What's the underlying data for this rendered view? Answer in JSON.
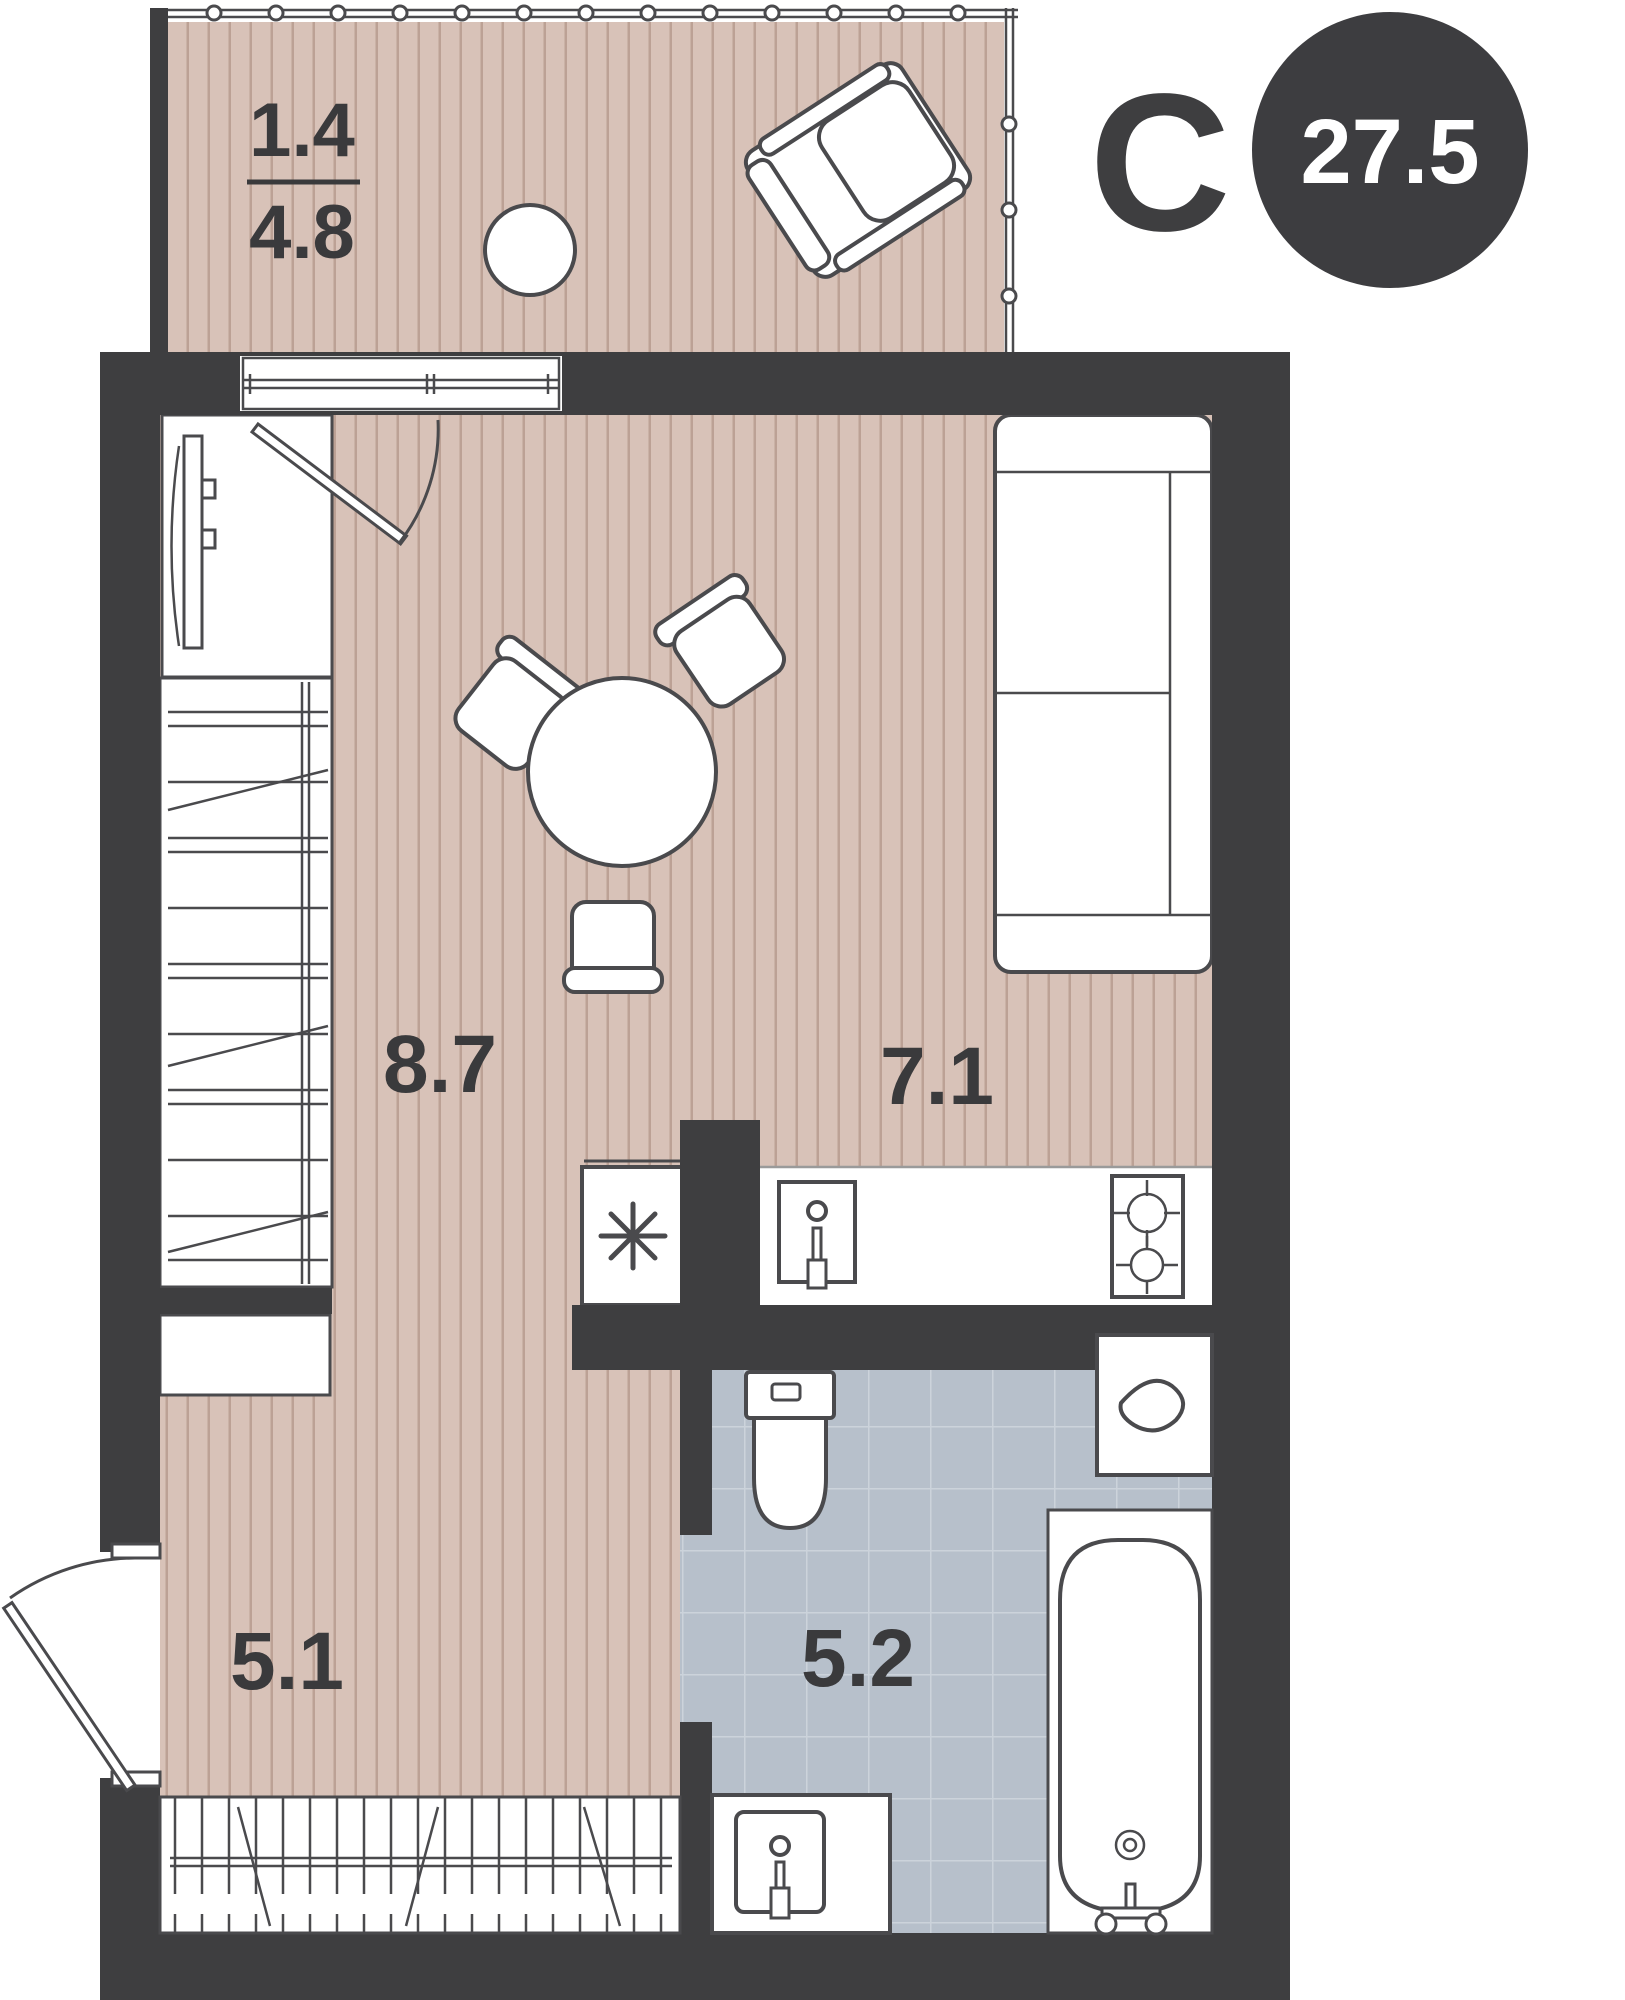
{
  "plan": {
    "total_area_badge": "27.5",
    "compass": {
      "north_letter": "С"
    },
    "balcony": {
      "area_reduced": "1.4",
      "area_full": "4.8"
    },
    "rooms": {
      "living": {
        "label": "8.7"
      },
      "kitchen": {
        "label": "7.1"
      },
      "hallway": {
        "label": "5.1"
      },
      "bathroom": {
        "label": "5.2"
      }
    },
    "colors": {
      "wall": "#3e3e40",
      "floor_wood": "#d8c2b8",
      "floor_wood_stripe": "#bca195",
      "floor_tile": "#b7c0cb",
      "tile_grout": "#ccd3db",
      "furniture_stroke": "#4a4a4d",
      "label_text": "#3a3a3c",
      "badge_background": "#3d3d40",
      "badge_text": "#ffffff"
    }
  }
}
